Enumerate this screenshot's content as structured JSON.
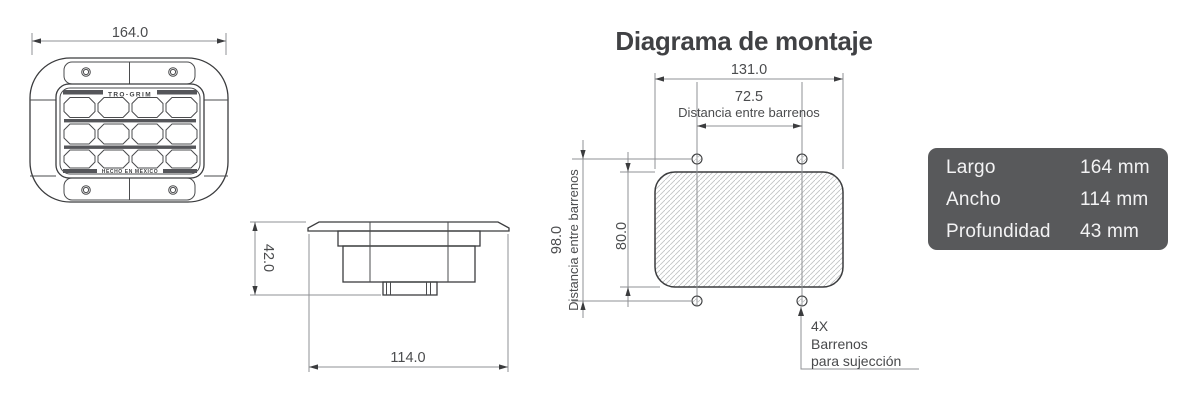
{
  "front_view": {
    "dim_length": "164.0",
    "brand": "TRO-GRIM",
    "made_in": "HECHO EN MEXICO"
  },
  "side_view": {
    "dim_depth": "42.0",
    "dim_width": "114.0"
  },
  "mounting_diagram": {
    "title": "Diagrama de montaje",
    "dim_cutout_width": "131.0",
    "dim_holes_horizontal": "72.5",
    "holes_horizontal_label": "Distancia entre barrenos",
    "dim_holes_vertical": "98.0",
    "holes_vertical_label": "Distancia entre barrenos",
    "dim_cutout_height": "80.0",
    "holes_note_line1": "4X",
    "holes_note_line2": "Barrenos",
    "holes_note_line3": "para sujección"
  },
  "spec_panel": {
    "rows": [
      {
        "label": "Largo",
        "value": "164 mm"
      },
      {
        "label": "Ancho",
        "value": "114 mm"
      },
      {
        "label": "Profundidad",
        "value": "43 mm"
      }
    ]
  },
  "colors": {
    "part_line": "#3b3c3e",
    "dimension_line": "#8f9194",
    "dimension_text": "#4b4c4e",
    "hatch_line": "#c2c3c5",
    "panel_background": "#58595b",
    "panel_text": "#f3f3f4",
    "title_text": "#404144"
  }
}
